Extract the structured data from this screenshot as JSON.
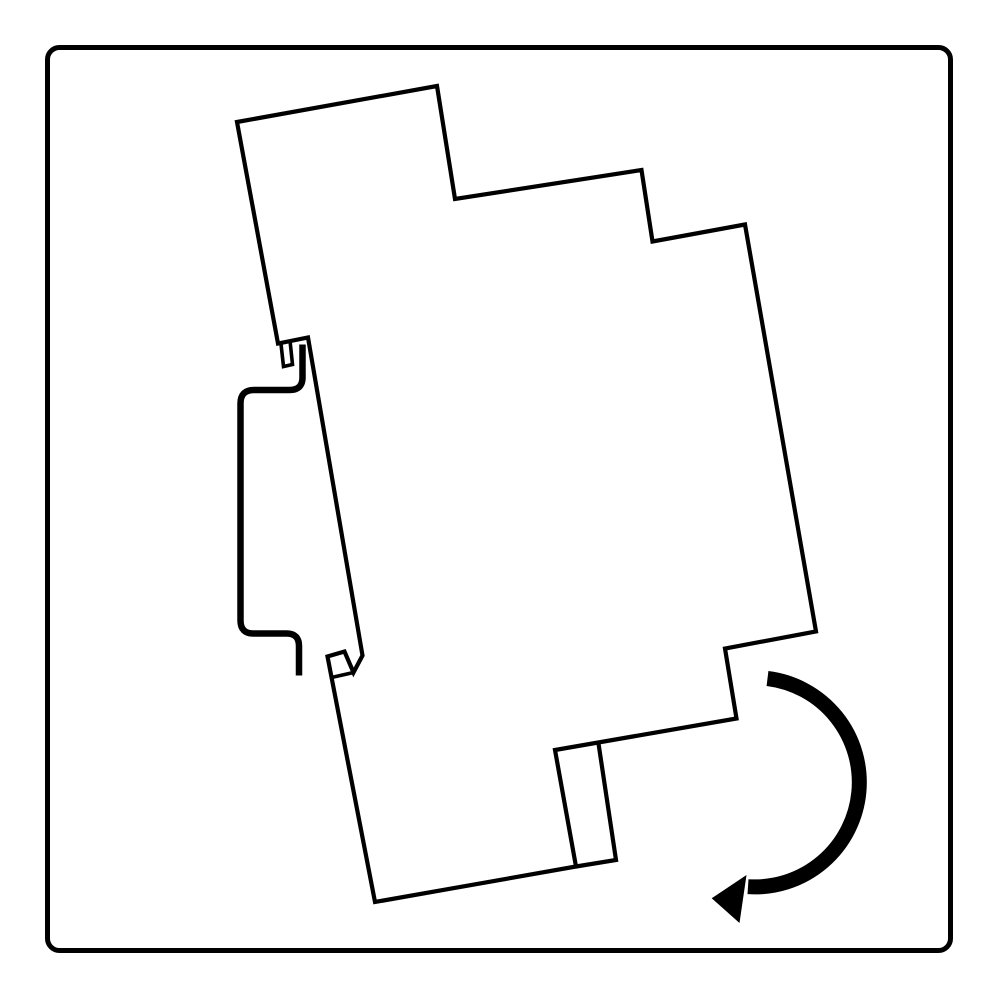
{
  "canvas": {
    "width": 1000,
    "height": 1000,
    "background": "#ffffff",
    "ink": "#000000"
  },
  "frame": {
    "x": 47.5,
    "y": 47.5,
    "width": 903,
    "height": 903,
    "radius": 12,
    "stroke_width": 5,
    "stroke": "#000000",
    "fill": "none"
  },
  "illustration": {
    "description": "Installation diagram: side profile of a DIN-rail device tilted about 10 degrees, hooked on the top flange of a DIN rail, with a curved arrow indicating downward rotation onto the rail",
    "paths": [
      {
        "name": "device-outline",
        "role": "device side profile",
        "d": "M 237 122 L 437 86 L 455 199 L 641.5 170 L 652.5 241.5 L 745 224.5 L 816 631.5 L 725 648.5 L 736.5 718.5 L 555 750 L 576 866.5 L 375 902 L 327.5 656.5 L 344.5 651.5 L 353.5 672.5 L 362.5 655.5 L 308 337.5 L 278 343.5 Z",
        "stroke": "#000000",
        "stroke_width": 4.2,
        "fill": "none",
        "linejoin": "miter",
        "linecap": "butt"
      },
      {
        "name": "device-top-hook-notch",
        "role": "groove that hooks over rail top flange",
        "d": "M 281 344 L 283.5 366.5 L 292.5 364.5 L 290.2 342.5",
        "stroke": "#000000",
        "stroke_width": 3.6,
        "fill": "none",
        "linejoin": "miter",
        "linecap": "butt"
      },
      {
        "name": "device-bottom-clip-edge",
        "role": "lower spring clip inner edge",
        "d": "M 353.5 672.5 L 331.5 677.5",
        "stroke": "#000000",
        "stroke_width": 3.6,
        "fill": "none",
        "linejoin": "miter",
        "linecap": "butt"
      },
      {
        "name": "device-bottom-foot",
        "role": "mounting foot below bottom edge",
        "d": "M 598.5 743.5 L 616 860 L 576 866.5",
        "stroke": "#000000",
        "stroke_width": 4.2,
        "fill": "none",
        "linejoin": "miter",
        "linecap": "butt"
      },
      {
        "name": "din-rail-profile",
        "role": "DIN rail hat-section side profile",
        "d": "M 302.5 344.5 L 302.5 377.5 Q 302.5 390 289.5 390 L 254 390 Q 240.5 390 240.5 403.5 L 240.5 620.5 Q 240.5 633.5 253.5 633.5 L 286.5 633.5 Q 299 633.5 299 646 L 299 675.5",
        "stroke": "#000000",
        "stroke_width": 6.5,
        "fill": "none",
        "linejoin": "round",
        "linecap": "butt"
      },
      {
        "name": "rotation-arrow-arc",
        "role": "clockwise rotation indicator arc",
        "d": "M 767.5 678.5 A 104.6 104.6 0 0 1 748 886.7",
        "stroke": "#000000",
        "stroke_width": 15,
        "fill": "none",
        "linejoin": "round",
        "linecap": "butt"
      },
      {
        "name": "rotation-arrow-head",
        "role": "arrowhead pointing toward rail",
        "d": "M 711.7 898.3 L 746.5 875 L 739.5 923 Z",
        "stroke": "none",
        "stroke_width": 0,
        "fill": "#000000",
        "linejoin": "miter",
        "linecap": "butt"
      }
    ]
  }
}
